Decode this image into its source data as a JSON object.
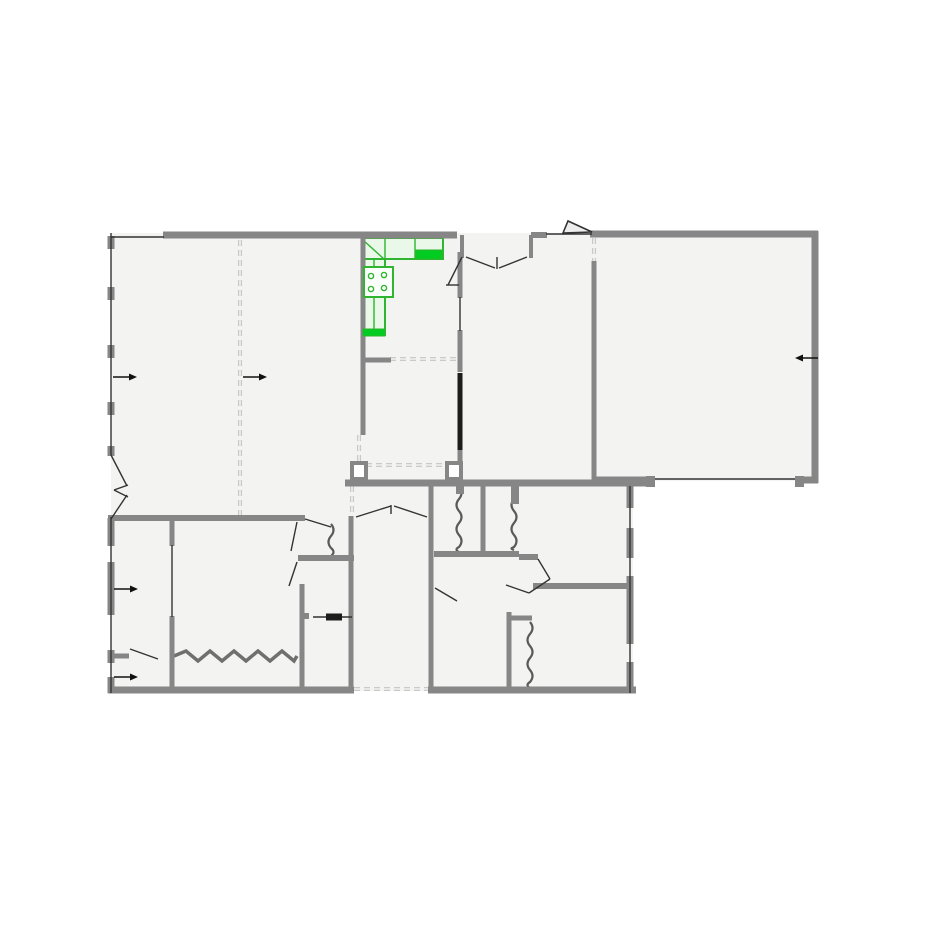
{
  "canvas": {
    "width": 925,
    "height": 925,
    "background": "#ffffff"
  },
  "colors": {
    "floor": "#f3f3f1",
    "wall": "#868686",
    "wall_dark": "#1c1c1c",
    "thin": "#333333",
    "dashed": "#c9c9c9",
    "squiggle": "#5a5a5a",
    "zigzag": "#6f6f6f",
    "arrow": "#111111",
    "kitchen_stroke": "#2fb52f",
    "kitchen_fill": "#e9f8e9",
    "kitchen_solid": "#00cc22",
    "triangle_fill": "#ededed"
  },
  "floor_polygon": [
    [
      111,
      233
    ],
    [
      815,
      233
    ],
    [
      815,
      481
    ],
    [
      633,
      481
    ],
    [
      633,
      691
    ],
    [
      111,
      691
    ]
  ],
  "walls": [
    {
      "name": "top-wall",
      "x1": 163,
      "y1": 235,
      "x2": 361,
      "y2": 235,
      "w": 7
    },
    {
      "name": "top-wall-kitchen",
      "x1": 361,
      "y1": 235,
      "x2": 457,
      "y2": 235,
      "w": 7
    },
    {
      "name": "top-wall-entry",
      "x1": 531,
      "y1": 235,
      "x2": 547,
      "y2": 235,
      "w": 6
    },
    {
      "name": "top-wall-right",
      "x1": 590,
      "y1": 234,
      "x2": 818,
      "y2": 234,
      "w": 7
    },
    {
      "name": "right-wall",
      "x1": 815,
      "y1": 231,
      "x2": 815,
      "y2": 483,
      "w": 7
    },
    {
      "name": "bigroom-bottom-left",
      "x1": 592,
      "y1": 480,
      "x2": 649,
      "y2": 480,
      "w": 7
    },
    {
      "name": "bigroom-bottom-right",
      "x1": 799,
      "y1": 480,
      "x2": 818,
      "y2": 480,
      "w": 7
    },
    {
      "name": "mid-wall",
      "x1": 345,
      "y1": 483,
      "x2": 651,
      "y2": 483,
      "w": 7
    },
    {
      "name": "bottom-wall-left",
      "x1": 108,
      "y1": 690,
      "x2": 354,
      "y2": 690,
      "w": 7
    },
    {
      "name": "bottom-wall-right",
      "x1": 428,
      "y1": 690,
      "x2": 636,
      "y2": 690,
      "w": 7
    },
    {
      "name": "livingroom-south-wall",
      "x1": 108,
      "y1": 518,
      "x2": 305,
      "y2": 518,
      "w": 6
    },
    {
      "name": "vestibule-south-wall",
      "x1": 298,
      "y1": 558,
      "x2": 354,
      "y2": 558,
      "w": 6
    },
    {
      "name": "corridor-right-wall",
      "x1": 431,
      "y1": 486,
      "x2": 431,
      "y2": 693,
      "w": 5
    },
    {
      "name": "corridor-left-wall",
      "x1": 351,
      "y1": 516,
      "x2": 351,
      "y2": 693,
      "w": 5
    },
    {
      "name": "bath-west-wall",
      "x1": 302,
      "y1": 584,
      "x2": 302,
      "y2": 693,
      "w": 5
    },
    {
      "name": "bedroom-wall-top",
      "x1": 172,
      "y1": 518,
      "x2": 172,
      "y2": 546,
      "w": 5
    },
    {
      "name": "bedroom-wall-bottom",
      "x1": 172,
      "y1": 616,
      "x2": 172,
      "y2": 693,
      "w": 5
    },
    {
      "name": "entry-nook-wall",
      "x1": 108,
      "y1": 656,
      "x2": 129,
      "y2": 656,
      "w": 5
    },
    {
      "name": "living-east-wall",
      "x1": 363,
      "y1": 232,
      "x2": 363,
      "y2": 435,
      "w": 5
    },
    {
      "name": "kitchen-east-wall-a",
      "x1": 460,
      "y1": 252,
      "x2": 460,
      "y2": 298,
      "w": 5
    },
    {
      "name": "kitchen-east-wall-b",
      "x1": 460,
      "y1": 330,
      "x2": 460,
      "y2": 372,
      "w": 5
    },
    {
      "name": "kitchen-east-wall-c",
      "x1": 460,
      "y1": 450,
      "x2": 460,
      "y2": 483,
      "w": 5
    },
    {
      "name": "dining-east-wall",
      "x1": 594,
      "y1": 261,
      "x2": 594,
      "y2": 481,
      "w": 5
    },
    {
      "name": "kitchen-south-stub",
      "x1": 365,
      "y1": 360,
      "x2": 391,
      "y2": 360,
      "w": 5
    },
    {
      "name": "entry-recess-left",
      "x1": 462,
      "y1": 235,
      "x2": 462,
      "y2": 258,
      "w": 4
    },
    {
      "name": "entry-recess-right",
      "x1": 531,
      "y1": 235,
      "x2": 531,
      "y2": 258,
      "w": 4
    },
    {
      "name": "closet-divider",
      "x1": 483,
      "y1": 486,
      "x2": 483,
      "y2": 554,
      "w": 5
    },
    {
      "name": "closet-south-wall",
      "x1": 434,
      "y1": 554,
      "x2": 519,
      "y2": 554,
      "w": 6
    },
    {
      "name": "closet-south-offset",
      "x1": 519,
      "y1": 557,
      "x2": 538,
      "y2": 557,
      "w": 6
    },
    {
      "name": "midright-wall",
      "x1": 533,
      "y1": 586,
      "x2": 630,
      "y2": 586,
      "w": 6
    },
    {
      "name": "se-closet-wall-v",
      "x1": 509,
      "y1": 612,
      "x2": 509,
      "y2": 693,
      "w": 5
    },
    {
      "name": "se-closet-wall-h",
      "x1": 509,
      "y1": 618,
      "x2": 532,
      "y2": 618,
      "w": 5
    },
    {
      "name": "right-lower-pier-1",
      "x1": 630,
      "y1": 486,
      "x2": 630,
      "y2": 508,
      "w": 7
    },
    {
      "name": "right-lower-pier-2",
      "x1": 630,
      "y1": 528,
      "x2": 630,
      "y2": 558,
      "w": 7
    },
    {
      "name": "right-lower-pier-3",
      "x1": 630,
      "y1": 576,
      "x2": 630,
      "y2": 644,
      "w": 7
    },
    {
      "name": "right-lower-pier-4",
      "x1": 630,
      "y1": 662,
      "x2": 630,
      "y2": 693,
      "w": 7
    },
    {
      "name": "left-wall-pier-1",
      "x1": 111,
      "y1": 236,
      "x2": 111,
      "y2": 249,
      "w": 7
    },
    {
      "name": "left-wall-pier-2",
      "x1": 111,
      "y1": 287,
      "x2": 111,
      "y2": 300,
      "w": 7
    },
    {
      "name": "left-wall-pier-3",
      "x1": 111,
      "y1": 345,
      "x2": 111,
      "y2": 358,
      "w": 7
    },
    {
      "name": "left-wall-pier-4",
      "x1": 111,
      "y1": 402,
      "x2": 111,
      "y2": 415,
      "w": 7
    },
    {
      "name": "left-wall-pier-5",
      "x1": 111,
      "y1": 446,
      "x2": 111,
      "y2": 456,
      "w": 7
    },
    {
      "name": "left-wall-pier-6",
      "x1": 111,
      "y1": 518,
      "x2": 111,
      "y2": 546,
      "w": 7
    },
    {
      "name": "left-wall-pier-7",
      "x1": 111,
      "y1": 562,
      "x2": 111,
      "y2": 615,
      "w": 7
    },
    {
      "name": "left-wall-pier-8",
      "x1": 111,
      "y1": 650,
      "x2": 111,
      "y2": 663,
      "w": 7
    },
    {
      "name": "left-wall-pier-9",
      "x1": 111,
      "y1": 677,
      "x2": 111,
      "y2": 693,
      "w": 7
    }
  ],
  "thin_lines": [
    {
      "name": "left-wall-line-upper",
      "x1": 111,
      "y1": 233,
      "x2": 111,
      "y2": 455
    },
    {
      "name": "left-wall-line-lower",
      "x1": 111,
      "y1": 517,
      "x2": 111,
      "y2": 693
    },
    {
      "name": "top-left-wall-line",
      "x1": 111,
      "y1": 237,
      "x2": 164,
      "y2": 237
    },
    {
      "name": "entry-side-wall-line",
      "x1": 546,
      "y1": 234,
      "x2": 564,
      "y2": 234
    },
    {
      "name": "bigroom-opening-line",
      "x1": 651,
      "y1": 479,
      "x2": 800,
      "y2": 479
    },
    {
      "name": "right-lower-wall-line",
      "x1": 630,
      "y1": 486,
      "x2": 630,
      "y2": 693
    },
    {
      "name": "bedroom-opening-line",
      "x1": 172,
      "y1": 545,
      "x2": 172,
      "y2": 617
    },
    {
      "name": "kitchen-east-opening-line",
      "x1": 460,
      "y1": 297,
      "x2": 460,
      "y2": 331
    },
    {
      "name": "angled-wall-upper",
      "x1": 111,
      "y1": 455,
      "x2": 127,
      "y2": 486
    },
    {
      "name": "angled-wall-lower",
      "x1": 127,
      "y1": 495,
      "x2": 111,
      "y2": 519
    },
    {
      "name": "angled-wall-notch-a",
      "x1": 114,
      "y1": 490,
      "x2": 128,
      "y2": 485
    },
    {
      "name": "angled-wall-notch-b",
      "x1": 114,
      "y1": 490,
      "x2": 128,
      "y2": 497
    },
    {
      "name": "door-leaf-vestibule-a",
      "x1": 305,
      "y1": 519,
      "x2": 331,
      "y2": 527
    },
    {
      "name": "door-leaf-vestibule-b",
      "x1": 297,
      "y1": 522,
      "x2": 291,
      "y2": 551
    },
    {
      "name": "door-leaf-bathroom",
      "x1": 297,
      "y1": 562,
      "x2": 289,
      "y2": 586
    },
    {
      "name": "double-door-leaf-left",
      "x1": 356,
      "y1": 517,
      "x2": 391,
      "y2": 506
    },
    {
      "name": "door-tick-corridor",
      "x1": 391,
      "y1": 505,
      "x2": 391,
      "y2": 514
    },
    {
      "name": "double-door-leaf-right",
      "x1": 394,
      "y1": 506,
      "x2": 427,
      "y2": 517
    },
    {
      "name": "door-leaf-entry-nook",
      "x1": 130,
      "y1": 649,
      "x2": 158,
      "y2": 659
    },
    {
      "name": "double-door-leaf-foyer-l",
      "x1": 466,
      "y1": 257,
      "x2": 495,
      "y2": 268
    },
    {
      "name": "double-door-leaf-foyer-r",
      "x1": 527,
      "y1": 257,
      "x2": 499,
      "y2": 268
    },
    {
      "name": "door-tick-foyer",
      "x1": 497,
      "y1": 257,
      "x2": 497,
      "y2": 269
    },
    {
      "name": "door-leaf-kitchen",
      "x1": 462,
      "y1": 257,
      "x2": 448,
      "y2": 285
    },
    {
      "name": "door-tick-kitchen",
      "x1": 446,
      "y1": 285,
      "x2": 459,
      "y2": 285
    },
    {
      "name": "door-leaf-midright-a",
      "x1": 538,
      "y1": 559,
      "x2": 550,
      "y2": 579
    },
    {
      "name": "door-leaf-midright-b",
      "x1": 550,
      "y1": 579,
      "x2": 529,
      "y2": 593
    },
    {
      "name": "door-leaf-midright-c",
      "x1": 529,
      "y1": 593,
      "x2": 506,
      "y2": 585
    },
    {
      "name": "door-leaf-seroom",
      "x1": 435,
      "y1": 588,
      "x2": 457,
      "y2": 601
    },
    {
      "name": "pocket-door-track",
      "x1": 313,
      "y1": 617,
      "x2": 352,
      "y2": 617
    },
    {
      "name": "entry-threshold",
      "x1": 563,
      "y1": 234,
      "x2": 592,
      "y2": 234
    }
  ],
  "black_segments": [
    {
      "name": "pocket-door-panel-kitchen",
      "x1": 460,
      "y1": 373,
      "x2": 460,
      "y2": 450,
      "w": 5
    },
    {
      "name": "pocket-door-panel-bath",
      "x1": 326,
      "y1": 617,
      "x2": 342,
      "y2": 617,
      "w": 7
    }
  ],
  "dashed_lines": [
    {
      "name": "room-divider-dashed",
      "x1": 240,
      "y1": 240,
      "x2": 240,
      "y2": 516
    },
    {
      "name": "kitchen-pass-dashed",
      "x1": 390,
      "y1": 359,
      "x2": 458,
      "y2": 359
    },
    {
      "name": "vestibule-dashed",
      "x1": 366,
      "y1": 465,
      "x2": 447,
      "y2": 465
    },
    {
      "name": "wall-gap-dashed-a",
      "x1": 359,
      "y1": 435,
      "x2": 359,
      "y2": 461
    },
    {
      "name": "wall-gap-dashed-b",
      "x1": 352,
      "y1": 486,
      "x2": 352,
      "y2": 515
    },
    {
      "name": "corridor-threshold-dashed",
      "x1": 354,
      "y1": 689,
      "x2": 428,
      "y2": 689
    },
    {
      "name": "window-dashed-bigroom",
      "x1": 594,
      "y1": 238,
      "x2": 594,
      "y2": 261
    }
  ],
  "squiggles": [
    {
      "name": "closet-accordion-door-1",
      "x": 459,
      "y1": 487,
      "y2": 552
    },
    {
      "name": "closet-accordion-door-2",
      "x": 514,
      "y1": 487,
      "y2": 550
    },
    {
      "name": "closet-accordion-door-3",
      "x": 331,
      "y1": 524,
      "y2": 556
    },
    {
      "name": "closet-accordion-door-4",
      "x": 530,
      "y1": 622,
      "y2": 688
    }
  ],
  "zigzags": [
    {
      "name": "closet-zigzag-door",
      "y": 656,
      "x1": 174,
      "x2": 297,
      "amp": 5,
      "step": 12
    }
  ],
  "posts_open": [
    {
      "name": "column-post-left",
      "x": 352,
      "y": 463,
      "w": 14,
      "h": 16
    },
    {
      "name": "column-post-right",
      "x": 447,
      "y": 463,
      "w": 14,
      "h": 16
    }
  ],
  "posts_solid": [
    {
      "name": "wall-post-a",
      "x": 646,
      "y": 476,
      "w": 9,
      "h": 11
    },
    {
      "name": "wall-post-b",
      "x": 795,
      "y": 476,
      "w": 9,
      "h": 11
    },
    {
      "name": "closet-anchor-a",
      "x": 456,
      "y": 486,
      "w": 8,
      "h": 8
    },
    {
      "name": "closet-anchor-b",
      "x": 511,
      "y": 486,
      "w": 8,
      "h": 18
    },
    {
      "name": "bath-wall-tick",
      "x": 302,
      "y": 613,
      "w": 7,
      "h": 6
    }
  ],
  "arrows": [
    {
      "name": "direction-arrow-living-1",
      "x1": 113,
      "y1": 377,
      "x2": 137,
      "y2": 377
    },
    {
      "name": "direction-arrow-living-2",
      "x1": 243,
      "y1": 377,
      "x2": 267,
      "y2": 267,
      "y2_fix": 377
    },
    {
      "name": "direction-arrow-bigroom",
      "x1": 818,
      "y1": 358,
      "x2": 795,
      "y2": 358
    },
    {
      "name": "direction-arrow-bedroom",
      "x1": 114,
      "y1": 589,
      "x2": 138,
      "y2": 589
    },
    {
      "name": "direction-arrow-nook",
      "x1": 114,
      "y1": 677,
      "x2": 138,
      "y2": 677
    }
  ],
  "entry_triangle": {
    "name": "entry-door-flap",
    "points": [
      [
        563,
        233
      ],
      [
        568,
        221
      ],
      [
        592,
        232
      ]
    ]
  },
  "kitchen": {
    "counters": [
      {
        "name": "kitchen-counter-top",
        "x": 363,
        "y": 238,
        "w": 80,
        "h": 21
      },
      {
        "name": "kitchen-counter-left",
        "x": 364,
        "y": 259,
        "w": 21,
        "h": 76
      }
    ],
    "lines": [
      {
        "name": "kitchen-corner-diagonal",
        "x1": 363,
        "y1": 240,
        "x2": 384,
        "y2": 259
      },
      {
        "name": "kitchen-cabinet-divider",
        "x1": 385,
        "y1": 238,
        "x2": 385,
        "y2": 259
      },
      {
        "name": "kitchen-sink-edge",
        "x1": 415,
        "y1": 238,
        "x2": 415,
        "y2": 259
      },
      {
        "name": "kitchen-counter-inner-line",
        "x1": 374,
        "y1": 259,
        "x2": 374,
        "y2": 335
      }
    ],
    "solids": [
      {
        "name": "kitchen-sink",
        "x": 416,
        "y": 250,
        "w": 26,
        "h": 9
      },
      {
        "name": "kitchen-counter-cap",
        "x": 363,
        "y": 329,
        "w": 22,
        "h": 7
      }
    ],
    "stove": {
      "name": "stove",
      "x": 364,
      "y": 267,
      "w": 29,
      "h": 30
    },
    "burners": [
      {
        "cx": 371,
        "cy": 276,
        "r": 2.6
      },
      {
        "cx": 384,
        "cy": 275,
        "r": 2.6
      },
      {
        "cx": 371,
        "cy": 289,
        "r": 2.6
      },
      {
        "cx": 384,
        "cy": 288,
        "r": 2.6
      }
    ]
  }
}
